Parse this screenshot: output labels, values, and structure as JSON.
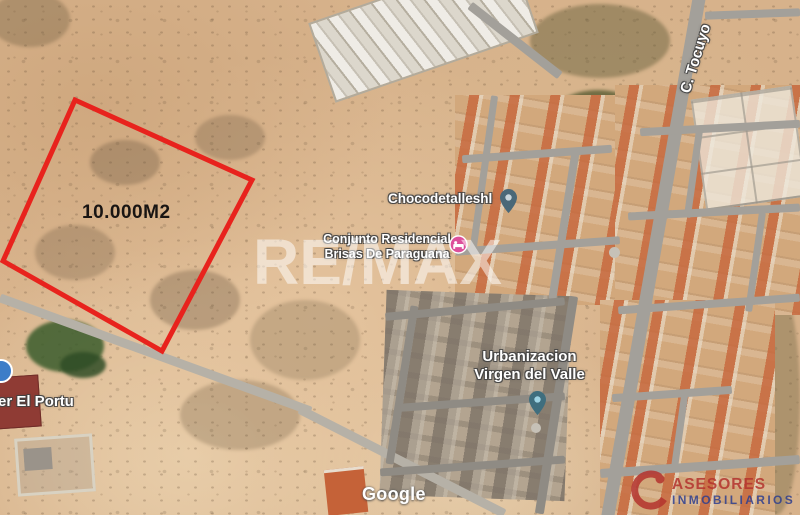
{
  "map": {
    "view_type": "satellite",
    "watermark_text": "RE/MAX",
    "attribution_text": "Google",
    "street_label": "C. Tocuyo",
    "parcel": {
      "area_label": "10.000M2",
      "outline_color": "#e8231d",
      "points": "75,100 252,180 162,351 3,261"
    },
    "places": [
      {
        "name": "Chocodetalleshl",
        "pin": "place-pin",
        "pin_color": "#4a6878",
        "pin_dot_color": "#c8d5dc"
      },
      {
        "name_line1": "Conjunto Residencial",
        "name_line2": "Brisas De Paraguana",
        "pin": "lodging-pin",
        "pin_color": "#dd4f9b"
      },
      {
        "name_line1": "Urbanizacion",
        "name_line2": "Virgen del Valle",
        "pin": "place-pin",
        "pin_color": "#3f6e7e",
        "pin_dot_color": "#9fd4e4"
      },
      {
        "name": "er El Portu",
        "pin": "place-circle",
        "pin_color": "#3d7dc8"
      }
    ]
  },
  "branding": {
    "line1": "ASESORES",
    "line2": "INMOBILIARIOS",
    "color_line1": "#b4332e",
    "color_line2": "#2e3f8f"
  }
}
